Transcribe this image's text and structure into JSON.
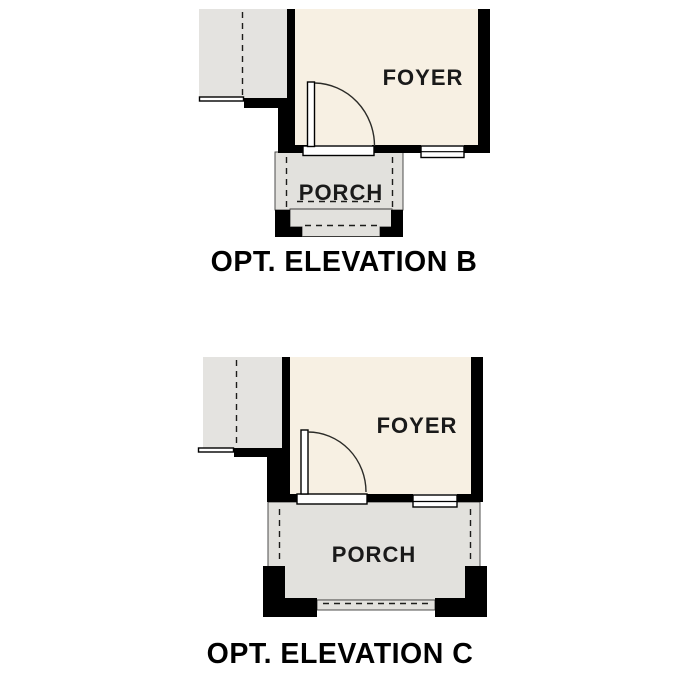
{
  "palette": {
    "background": "#FFFFFF",
    "wall_black": "#000000",
    "foyer_fill": "#F7F0E3",
    "adjacent_room_fill": "#E4E3E0",
    "porch_fill": "#E2E1DD",
    "line_dark": "#1C1C1A",
    "label_color": "#000000"
  },
  "diagrams": [
    {
      "caption": "OPT. ELEVATION B",
      "rooms": [
        {
          "label": "FOYER"
        },
        {
          "label": "PORCH"
        }
      ]
    },
    {
      "caption": "OPT. ELEVATION C",
      "rooms": [
        {
          "label": "FOYER"
        },
        {
          "label": "PORCH"
        }
      ]
    }
  ]
}
